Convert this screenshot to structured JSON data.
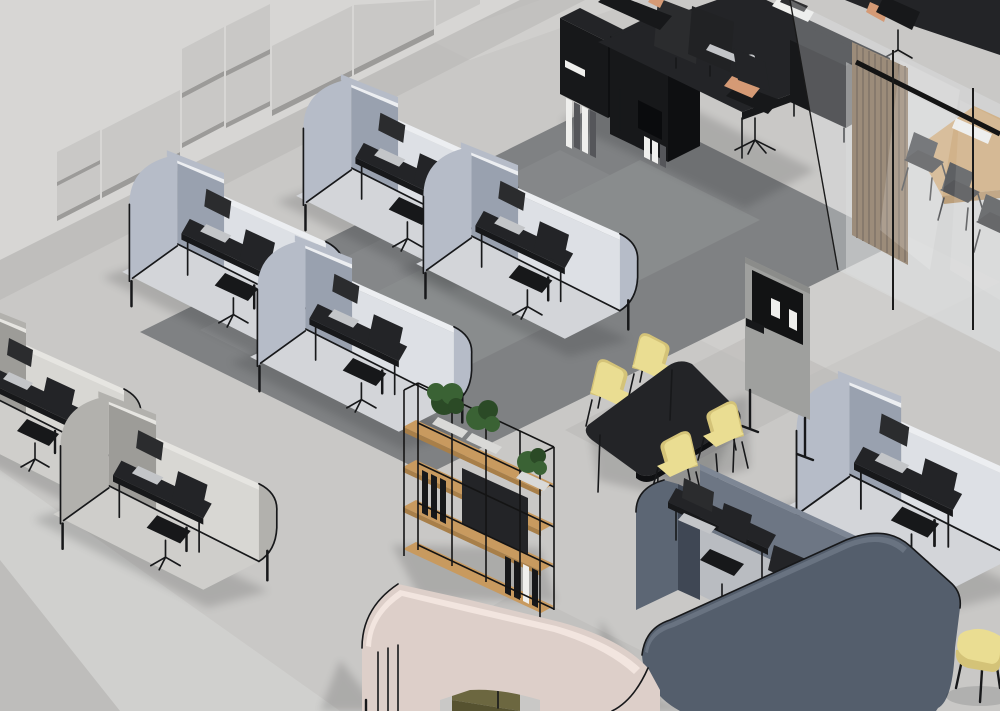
{
  "meta": {
    "title": "Isometric 3D render of an open office with acoustic work pods",
    "width": 1000,
    "height": 711
  },
  "palette": {
    "wall": "#d7d6d4",
    "wallShadow": "#b9b8b6",
    "panel": "#c9c8c6",
    "panelSide": "#9c9b99",
    "floor": "#c9c8c6",
    "floorLight": "#d6d5d3",
    "floorMid": "#b5b4b2",
    "carpet": "#7f8183",
    "carpetLight": "#8c8e90",
    "podBlueExt": "#b6bcc8",
    "podBlueInt": "#dde0e5",
    "podBlueShade": "#99a1af",
    "podRim": "#eceef1",
    "podFloor": "#d3d5d9",
    "podWarmExt": "#b2b1ad",
    "podWarmInt": "#d8d7d3",
    "podWarmShade": "#9d9c98",
    "podWarmRim": "#e6e5e1",
    "podWarmFloor": "#cfcecb",
    "podSlateExt": "#545e6c",
    "podSlateHood": "#5c6674",
    "podSlateInt": "#6d7684",
    "podSlateRim": "#7e8795",
    "podPinkExt": "#ddcfc9",
    "podPinkInt": "#ecdcd6",
    "podPinkRim": "#f2e5df",
    "black1": "#17181a",
    "black2": "#232427",
    "screenDark": "#2b2c2e",
    "laptopSilver": "#c3c5c8",
    "oak": "#c89a5f",
    "oakSide": "#a87f49",
    "woodSlat": "#7b6448",
    "woodSlatDark": "#5d4a35",
    "plant": "#3a6234",
    "plantDark": "#2b4a26",
    "planter": "#d9d9d7",
    "paper": "#efefed",
    "skin": "#d59a75",
    "olive": "#6c6740",
    "oliveDark": "#565230",
    "chairYellow": "#eadd92",
    "chairYellowDark": "#d4c378",
    "pinboard": "#121314",
    "partition": "#9fa09e",
    "glass": "#e7eaed"
  },
  "scene": {
    "wall": {
      "label": "Concrete wall with grey acoustic panels",
      "panel_count": 10
    },
    "floor": {
      "label": "Polished concrete floor with dark grey carpeted work zone"
    },
    "work_pods_blue": {
      "label": "Light blue-grey acoustic work pods",
      "count": 5,
      "contents": [
        "black desk",
        "silver laptop",
        "black task chair"
      ]
    },
    "work_pods_grey": {
      "label": "Warm grey acoustic work pods",
      "count": 2,
      "contents": [
        "black desk",
        "black task chair"
      ]
    },
    "workstation": {
      "label": "Black double workstation with monitors, shelving and binders",
      "monitors": 2,
      "chairs": 2,
      "people": 2
    },
    "glass_room": {
      "label": "Glass meeting room with oak table, black chairs and wood-slat curtain",
      "chairs": 3
    },
    "meeting_area": {
      "label": "Dark table with four pale-yellow chairs",
      "chairs": 4
    },
    "partition": {
      "label": "Mobile acoustic partition with black pinboard and pinned papers"
    },
    "shelving": {
      "label": "Black-frame open shelving with oak shelves, plants and binders",
      "plants": 3
    },
    "lounge_pod_pink": {
      "label": "Blush lounge pod with olive sofa, media screen and black table"
    },
    "work_pod_slate": {
      "label": "Slate-blue acoustic work pod with desk, laptop and chairs"
    },
    "ottoman": {
      "label": "Pale-yellow ottoman on black legs"
    }
  }
}
